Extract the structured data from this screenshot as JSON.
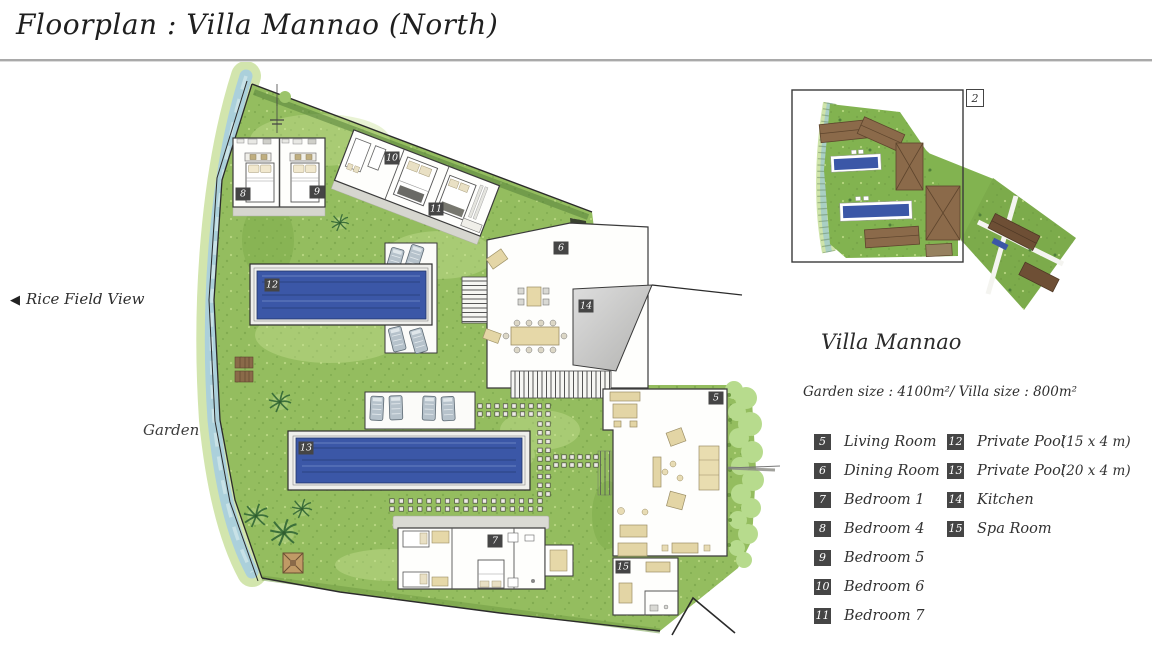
{
  "header": {
    "title": "Floorplan : Villa Mannao (North)"
  },
  "annotations": {
    "rice_field_arrow": "◀",
    "rice_field_label": "Rice Field View",
    "garden_label": "Garden",
    "overview_ref_label": "2"
  },
  "info": {
    "villa_name": "Villa Mannao",
    "size_line": "Garden size : 4100m²/ Villa size : 800m²"
  },
  "legend": {
    "column1": [
      {
        "num": "5",
        "label": "Living Room",
        "detail": ""
      },
      {
        "num": "6",
        "label": "Dining Room",
        "detail": ""
      },
      {
        "num": "7",
        "label": "Bedroom 1",
        "detail": ""
      },
      {
        "num": "8",
        "label": "Bedroom 4",
        "detail": ""
      },
      {
        "num": "9",
        "label": "Bedroom 5",
        "detail": ""
      },
      {
        "num": "10",
        "label": "Bedroom 6",
        "detail": ""
      },
      {
        "num": "11",
        "label": "Bedroom 7",
        "detail": ""
      }
    ],
    "column2": [
      {
        "num": "12",
        "label": "Private Pool",
        "detail": "(15 x 4 m)"
      },
      {
        "num": "13",
        "label": "Private Pool",
        "detail": "(20 x 4 m)"
      },
      {
        "num": "14",
        "label": "Kitchen",
        "detail": ""
      },
      {
        "num": "15",
        "label": "Spa Room",
        "detail": ""
      }
    ]
  },
  "plan_markers": [
    {
      "num": "5",
      "x": 716,
      "y": 398
    },
    {
      "num": "6",
      "x": 561,
      "y": 248
    },
    {
      "num": "7",
      "x": 495,
      "y": 541
    },
    {
      "num": "8",
      "x": 243,
      "y": 194
    },
    {
      "num": "9",
      "x": 317,
      "y": 192
    },
    {
      "num": "10",
      "x": 392,
      "y": 158
    },
    {
      "num": "11",
      "x": 436,
      "y": 209
    },
    {
      "num": "12",
      "x": 272,
      "y": 285
    },
    {
      "num": "13",
      "x": 306,
      "y": 448
    },
    {
      "num": "14",
      "x": 586,
      "y": 306
    },
    {
      "num": "15",
      "x": 623,
      "y": 567
    }
  ],
  "colors": {
    "pool": "#3b57a7",
    "lawn": "#94bd5f",
    "roof": "#8b6a4a",
    "marker_bg": "#454545"
  }
}
